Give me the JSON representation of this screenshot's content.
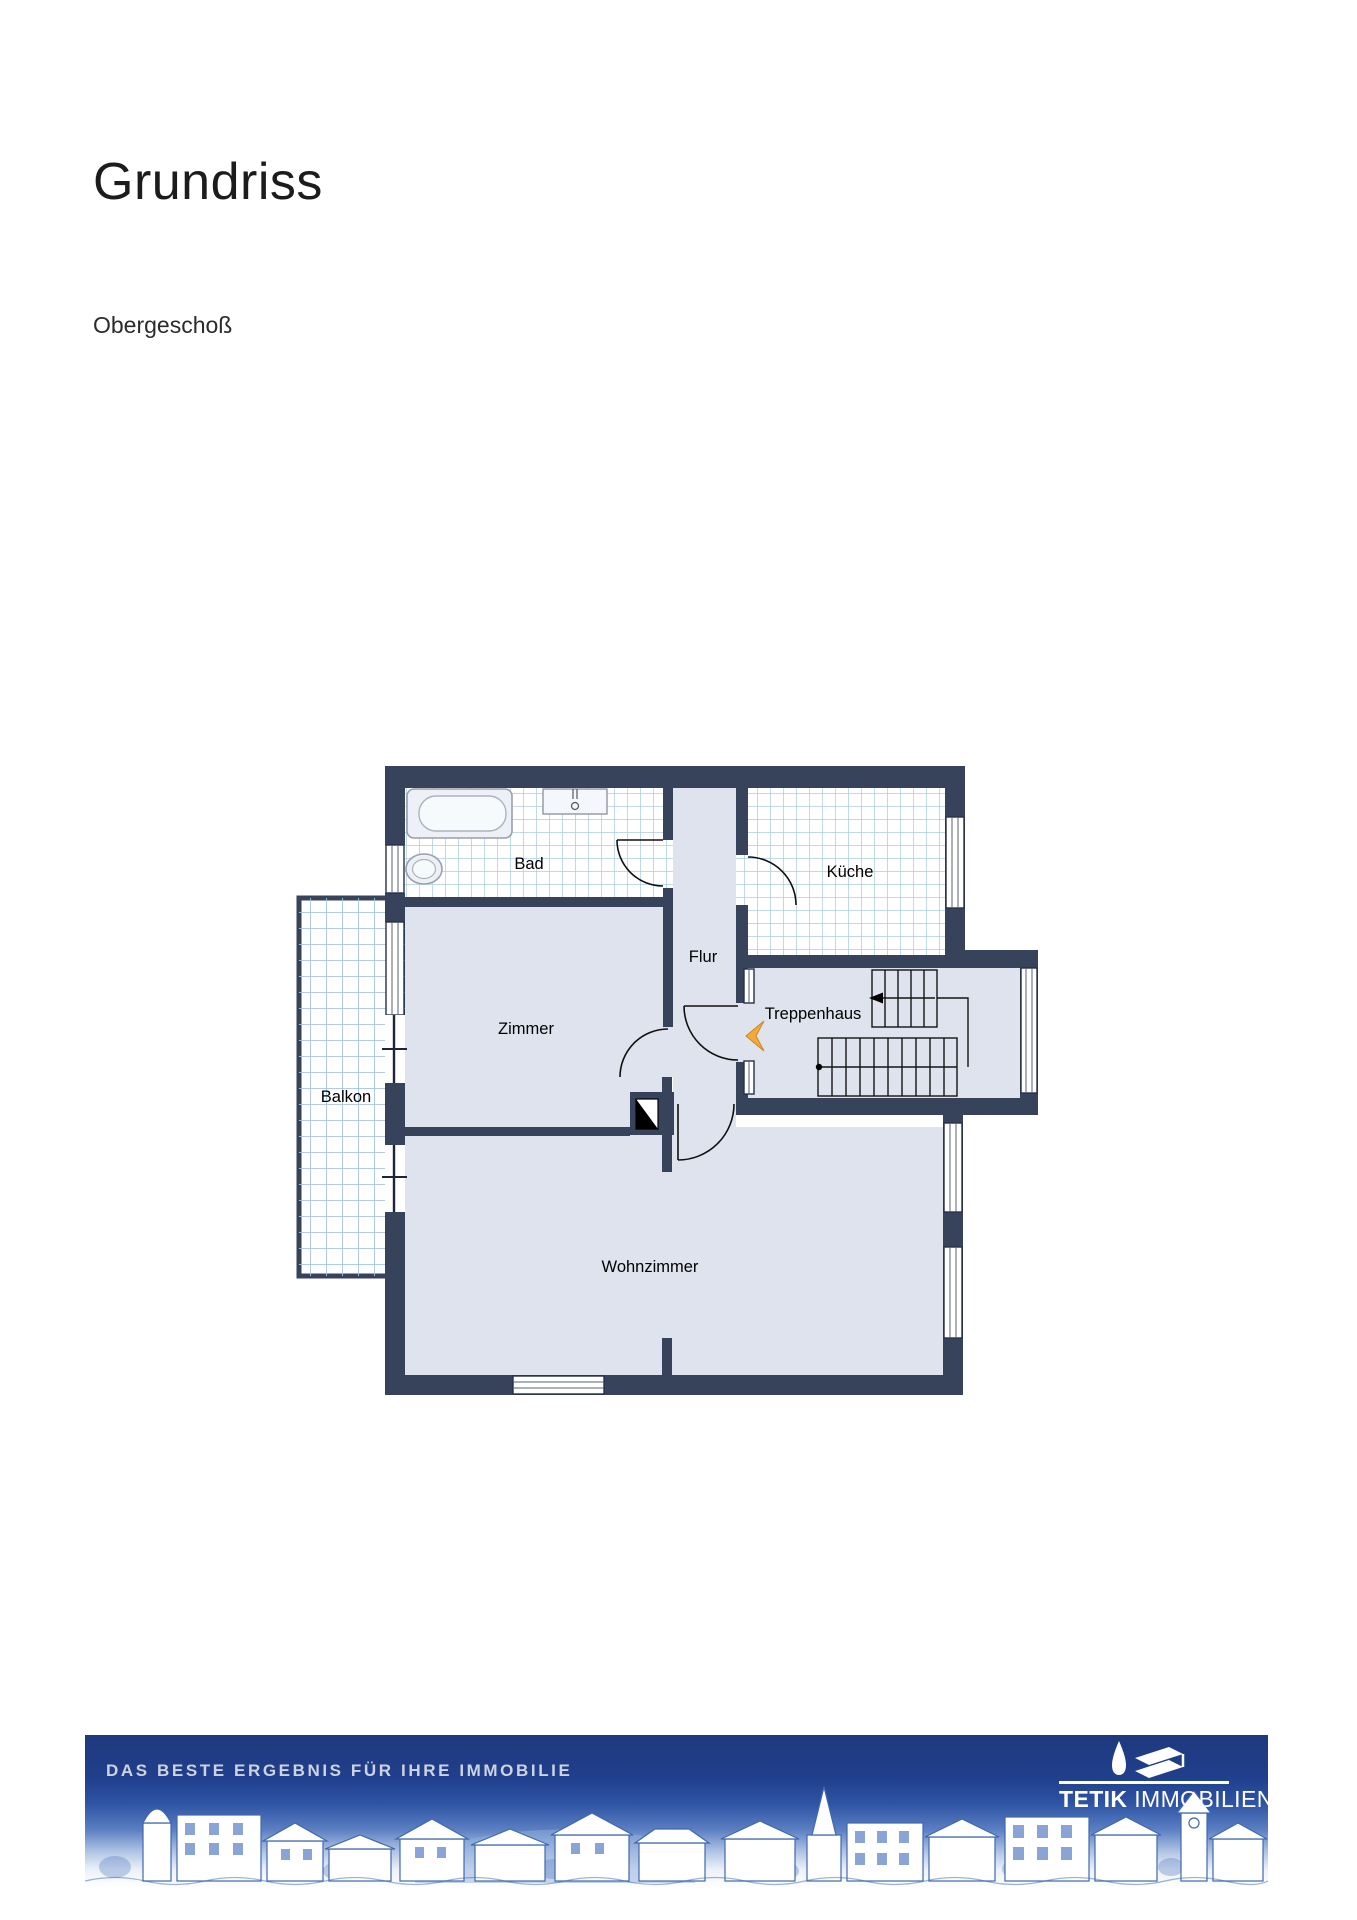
{
  "page": {
    "title": "Grundriss",
    "subtitle": "Obergeschoß"
  },
  "floorplan": {
    "floor": "Obergeschoß",
    "rooms": [
      {
        "label": "Bad"
      },
      {
        "label": "Küche"
      },
      {
        "label": "Flur"
      },
      {
        "label": "Treppenhaus"
      },
      {
        "label": "Zimmer"
      },
      {
        "label": "Balkon"
      },
      {
        "label": "Wohnzimmer"
      }
    ],
    "fixtures": [
      "bathtub",
      "sink",
      "toilet",
      "staircase",
      "chimney"
    ],
    "colors": {
      "wall": "#36435A",
      "floor_gray": "#DEE3ED",
      "tile_line": "#AECBEA",
      "entrance_arrow": "#F5A93B"
    }
  },
  "footer": {
    "tagline": "DAS BESTE ERGEBNIS FÜR IHRE IMMOBILIE",
    "brand": {
      "bold": "TETIK",
      "light": "IMMOBILIEN"
    },
    "colors": {
      "banner_top": "#1E3A7E",
      "skyline_ink": "#3F67B0"
    }
  }
}
